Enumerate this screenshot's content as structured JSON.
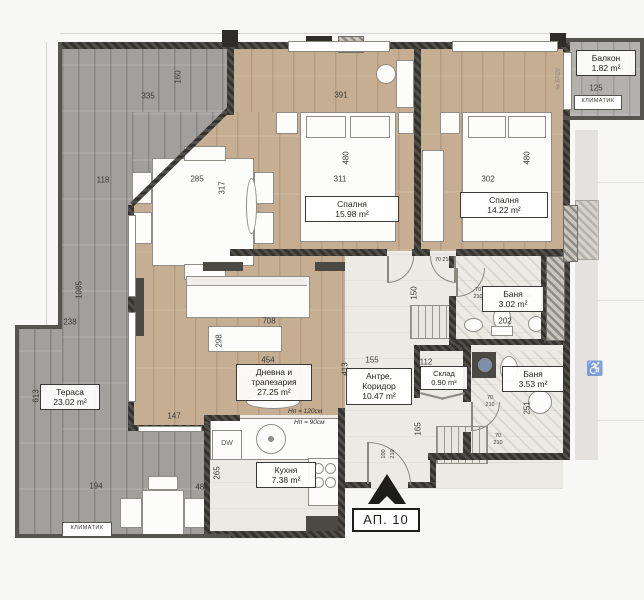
{
  "plan": {
    "apartment_label": "АП. 10",
    "rooms": {
      "balcony": {
        "name": "Балкон",
        "area": "1.82 m²"
      },
      "bedroom1": {
        "name": "Спалня",
        "area": "15.98 m²"
      },
      "bedroom2": {
        "name": "Спалня",
        "area": "14.22 m²"
      },
      "bath1": {
        "name": "Баня",
        "area": "3.02 m²"
      },
      "bath2": {
        "name": "Баня",
        "area": "3.53 m²"
      },
      "storage": {
        "name": "Склад",
        "area": "0.90 m²"
      },
      "hall": {
        "line1": "Антре,",
        "line2": "Коридор",
        "area": "10.47 m²"
      },
      "living": {
        "line1": "Дневна и",
        "line2": "трапезария",
        "area": "27.25 m²"
      },
      "kitchen": {
        "name": "Кухня",
        "area": "7.38 m²"
      },
      "terrace": {
        "name": "Тераса",
        "area": "23.02 m²"
      }
    },
    "notes": {
      "ac": "климатик",
      "dw": "DW",
      "h120": "Hп = 120см",
      "h90": "Hп = 90см",
      "beam": "6к Б7/20"
    },
    "icons": {
      "wheelchair": "♿"
    },
    "dims": {
      "d70": "70",
      "d100": "100",
      "d112": "112",
      "d118": "118",
      "d125": "125",
      "d145": "145",
      "d147": "147",
      "d150": "150",
      "d155": "155",
      "d160": "160",
      "d165": "165",
      "d194": "194",
      "d202": "202",
      "d210": "210",
      "d238": "238",
      "d251": "251",
      "d265": "265",
      "d285": "285",
      "d298": "298",
      "d302": "302",
      "d311": "311",
      "d317": "317",
      "d335": "335",
      "d391": "391",
      "d413": "413",
      "d454": "454",
      "d480": "480",
      "d486": "486",
      "d613": "613",
      "d708": "708",
      "d1085": "1085"
    },
    "colors": {
      "wall": "#45443f",
      "wood": "#c6ae92",
      "terrace": "#a2a09c",
      "light_floor": "#eceae5"
    }
  }
}
